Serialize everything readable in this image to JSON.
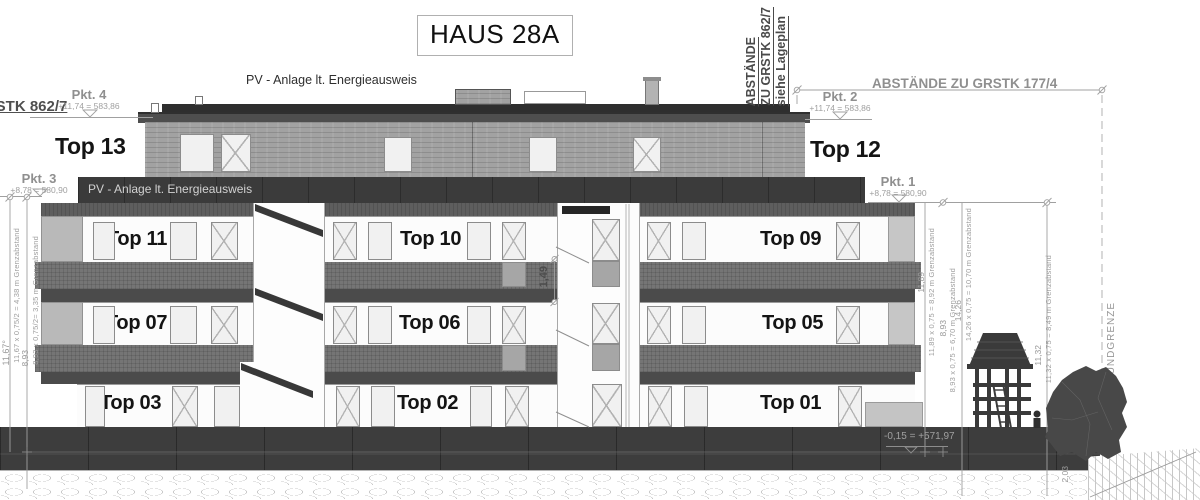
{
  "drawing": {
    "title": "HAUS 28A",
    "pv_note_top": "PV - Anlage lt. Energieausweis",
    "pv_note_band": "PV - Anlage lt. Energieausweis",
    "plot_label_left": "GSTK 862/7",
    "boundary_note_rotated": [
      "ABSTÄNDE",
      "ZU GRSTK 862/7",
      "siehe Lageplan"
    ],
    "boundary_note_right": "ABSTÄNDE ZU GRSTK 177/4",
    "boundary_line_label": "GRUNDGRENZE",
    "ground_level_note": "-0,15 = +571,97"
  },
  "survey_points": [
    {
      "name": "Pkt. 4",
      "value": "+11,74 = 583,86"
    },
    {
      "name": "Pkt. 3",
      "value": "+8,78 = 580,90"
    },
    {
      "name": "Pkt. 2",
      "value": "+11,74 = 583,86"
    },
    {
      "name": "Pkt. 1",
      "value": "+8,78 = 580,90"
    }
  ],
  "units": [
    {
      "label": "Top 13"
    },
    {
      "label": "Top 12"
    },
    {
      "label": "Top 11"
    },
    {
      "label": "Top 10"
    },
    {
      "label": "Top 09"
    },
    {
      "label": "Top 07"
    },
    {
      "label": "Top 06"
    },
    {
      "label": "Top 05"
    },
    {
      "label": "Top 03"
    },
    {
      "label": "Top 02"
    },
    {
      "label": "Top 01"
    }
  ],
  "dimensions": {
    "left": [
      {
        "value": "11,67°",
        "formula": "11,67 x 0,75/2 = 4,38 m Grenzabstand"
      },
      {
        "value": "8,93",
        "formula": "8,93 x 0,75/2= 3,35 m Grenzabstand"
      }
    ],
    "right": [
      {
        "value": "11,89",
        "formula": "11,89 x 0,75 = 8,92 m Grenzabstand"
      },
      {
        "value": "8,93",
        "formula": "8,93 x 0,75 = 6,70 m Grenzabstand"
      },
      {
        "value": "14,26",
        "formula": "14,26 x 0,75 = 10,70 m Grenzabstand"
      },
      {
        "value": "11,32",
        "formula": "11,32 x 0,75 = 8,49 m Grenzabstand"
      }
    ],
    "middle": {
      "value": "1,49"
    },
    "bottom_right": {
      "value": "2,03"
    }
  },
  "colors": {
    "paper": "#ffffff",
    "linework": "#9e9e9e",
    "attic_band": "#3b3b3b",
    "parapet": "#757575",
    "base_wall": "#3d3d3d",
    "label_text": "#141414",
    "survey_text": "#8f8f8f"
  }
}
